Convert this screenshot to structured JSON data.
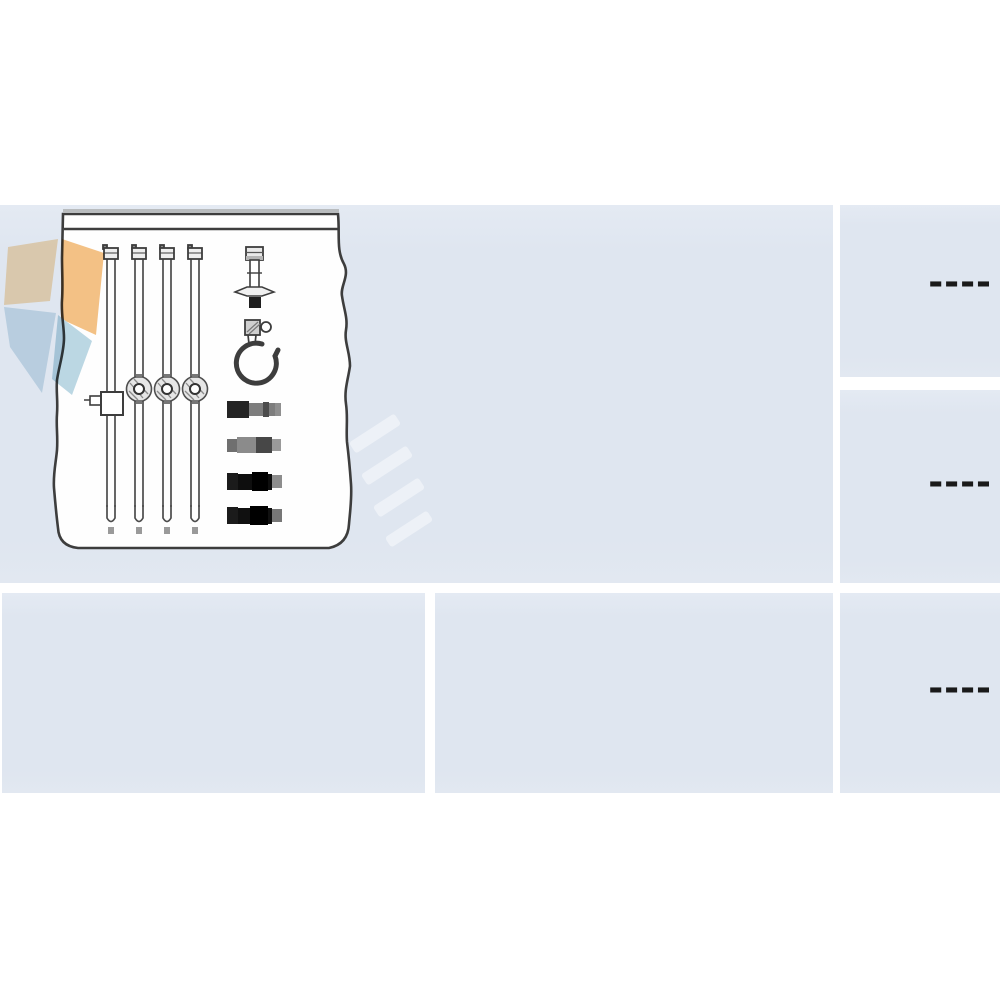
{
  "colors": {
    "page_bg": "#ffffff",
    "cell_bg": "#dfe6f0",
    "gap_color": "#fdfdfe",
    "drawing_line": "#3d3d3d",
    "paper_fill": "#fefefe",
    "dash_color": "#1a1a1a",
    "logo_orange_light": "#f8dcb2",
    "logo_orange": "#f4bd7c",
    "logo_blue_light": "#cfe2ec",
    "logo_blue": "#b7d5e2"
  },
  "catalog": {
    "image_cell": {
      "icon": "ignition-cable-kit-drawing",
      "parts": [
        "ignition-cable-icon",
        "ignition-cable-icon",
        "ignition-cable-icon",
        "ignition-cable-icon",
        "spark-plug-connector-icon",
        "hook-clip-icon",
        "terminal-sleeve-icon",
        "terminal-sleeve-icon",
        "terminal-sleeve-icon",
        "terminal-sleeve-icon"
      ]
    },
    "right_column": [
      {
        "value": "----"
      },
      {
        "value": "----"
      },
      {
        "value": "----"
      }
    ],
    "bottom_row": [
      {
        "value": ""
      },
      {
        "value": ""
      }
    ]
  },
  "logo": {
    "icon": "brand-diamond-logo"
  },
  "watermark": {
    "icon": "diagonal-stripes-watermark"
  }
}
